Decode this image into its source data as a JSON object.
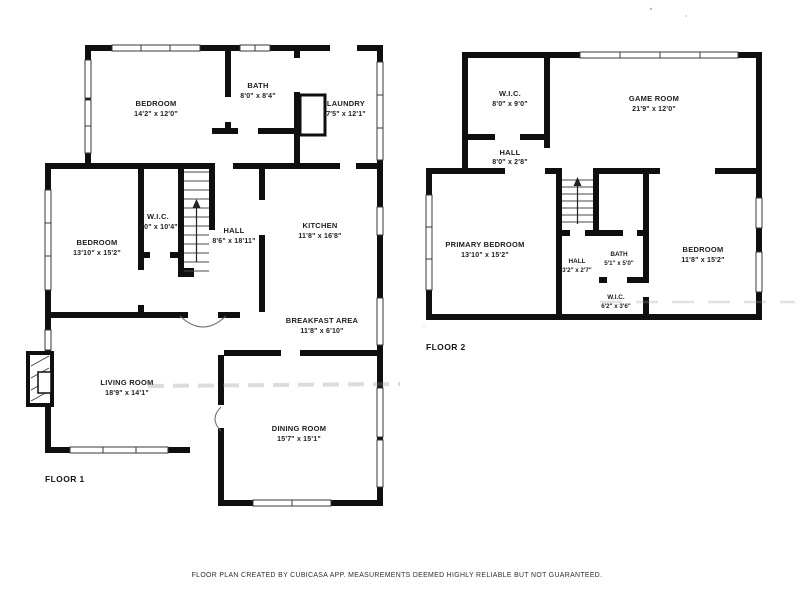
{
  "colors": {
    "wall": "#0f0f0f",
    "label_text": "#1d1d1d",
    "background": "#ffffff"
  },
  "footer": {
    "disclaimer": "FLOOR PLAN CREATED BY CUBICASA APP. MEASUREMENTS DEEMED HIGHLY RELIABLE BUT NOT GUARANTEED."
  },
  "floor1": {
    "label": "FLOOR 1",
    "rooms": [
      {
        "name": "BEDROOM",
        "dims": "14'2\" x 12'0\""
      },
      {
        "name": "BATH",
        "dims": "8'0\" x 8'4\""
      },
      {
        "name": "LAUNDRY",
        "dims": "7'5\" x 12'1\""
      },
      {
        "name": "W.I.C.",
        "dims": "4'0\" x 10'4\""
      },
      {
        "name": "BEDROOM",
        "dims": "13'10\" x 15'2\""
      },
      {
        "name": "HALL",
        "dims": "8'6\" x 18'11\""
      },
      {
        "name": "KITCHEN",
        "dims": "11'8\" x 16'8\""
      },
      {
        "name": "BREAKFAST AREA",
        "dims": "11'8\" x 6'10\""
      },
      {
        "name": "LIVING ROOM",
        "dims": "18'9\" x 14'1\""
      },
      {
        "name": "DINING ROOM",
        "dims": "15'7\" x 15'1\""
      }
    ]
  },
  "floor2": {
    "label": "FLOOR 2",
    "rooms": [
      {
        "name": "W.I.C.",
        "dims": "8'0\" x 9'0\""
      },
      {
        "name": "GAME ROOM",
        "dims": "21'9\" x 12'0\""
      },
      {
        "name": "HALL",
        "dims": "8'0\" x 2'8\""
      },
      {
        "name": "PRIMARY BEDROOM",
        "dims": "13'10\" x 15'2\""
      },
      {
        "name": "HALL",
        "dims": "3'2\" x 2'7\""
      },
      {
        "name": "BATH",
        "dims": "5'1\" x 5'0\""
      },
      {
        "name": "W.I.C.",
        "dims": "6'2\" x 3'6\""
      },
      {
        "name": "BEDROOM",
        "dims": "11'8\" x 15'2\""
      }
    ]
  }
}
